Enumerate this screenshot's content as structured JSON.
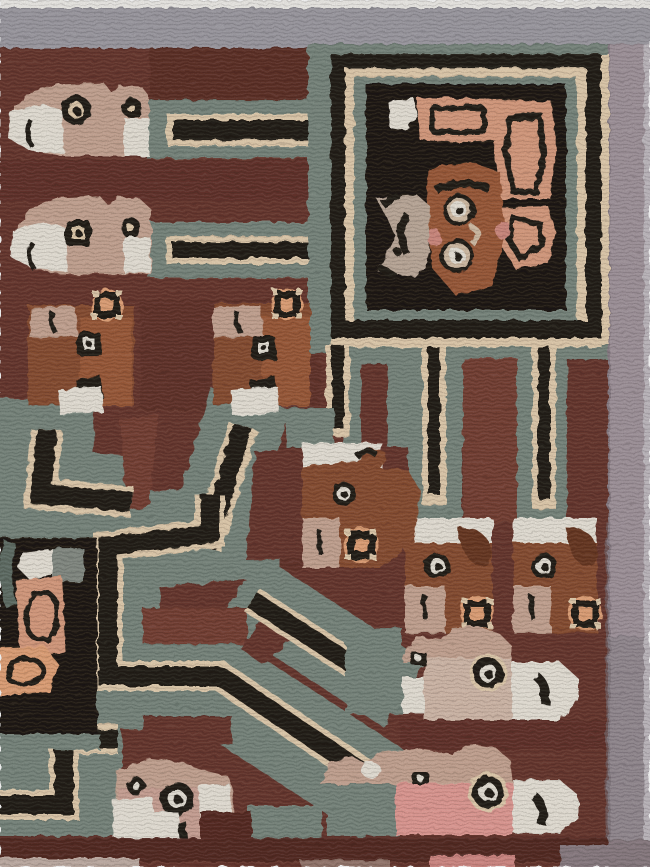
{
  "artwork": {
    "type": "textile-photograph",
    "style": "Pre-Columbian Wari / Tiwanaku-style pile weaving, corner fragment",
    "description": "Corner section of a hand-knotted rug: maroon field with stylized llama and bird heads, a large framed square containing an abstract face with a salmon headdress, stepped teal bands with black cream-outlined stripes forming a maze, small square rosettes, gray top border and mauve-gray right border.",
    "motifs": [
      {
        "name": "llama-head-left-row1",
        "description": "tan animal head facing left, cream muzzle, black-ringed eyes, teal band with black stripe extending right"
      },
      {
        "name": "llama-head-left-row2",
        "description": "second tan animal head below the first, band stripe joins the square frame line"
      },
      {
        "name": "framed-face-panel",
        "description": "large teal square panel, black and cream frame, dark interior with brown face, two ringed eyes, salmon curved headdress, gray-tan ear ornament, white patch"
      },
      {
        "name": "hanging-heads",
        "description": "three brown heads with white crowns hanging from vertical band cords, tan muzzles, square rosettes"
      },
      {
        "name": "row3-heads",
        "description": "two brown heads with tan caps, square eye, black mouth, white muzzle, diagonal leg bands"
      },
      {
        "name": "black-wing-panel",
        "description": "black panel at left edge holding salmon arm and foot shapes outlined in black, white patch"
      },
      {
        "name": "maze-bands",
        "description": "teal bands carrying black stripes outlined in cream, right angles and diagonals, sawtooth edges"
      },
      {
        "name": "right-facing-heads",
        "description": "two large tan-and-pink heads at lower right with white muzzles, black curved mouth, rosette eyes"
      },
      {
        "name": "pink-head-bottom-left",
        "description": "small pink head with double eyes and white muzzle at bottom left"
      },
      {
        "name": "rosettes",
        "description": "small square rosettes: black ring, salmon center, cream pips"
      }
    ]
  },
  "palette": {
    "field": "#6d3b32",
    "fieldLight": "#7b4539",
    "fieldDark": "#5c2f28",
    "bottomBand": "#5a2e27",
    "borderTop": "#a3a0a8",
    "borderTopWhite": "#f4f2ee",
    "borderRight": "#a79aa2",
    "borderRightLow": "#9a9097",
    "borderEdge": "#c6c0c6",
    "teal": "#7e8c83",
    "tealDark": "#65736b",
    "tealLight": "#95a29a",
    "black": "#26201a",
    "cream": "#e9d3b4",
    "creamSoft": "#d9c3ab",
    "white": "#efeadf",
    "tan": "#cdab99",
    "tanLight": "#d9c0b0",
    "brown": "#8e5236",
    "brownLight": "#a25e3e",
    "brownDark": "#6e3c25",
    "salmon": "#dfa284",
    "rosette": "#e9a87d",
    "pink": "#e8a09a",
    "darkPanel": "#231c15",
    "graytan": "#c3b0a0",
    "cheek": "#d68f84"
  }
}
